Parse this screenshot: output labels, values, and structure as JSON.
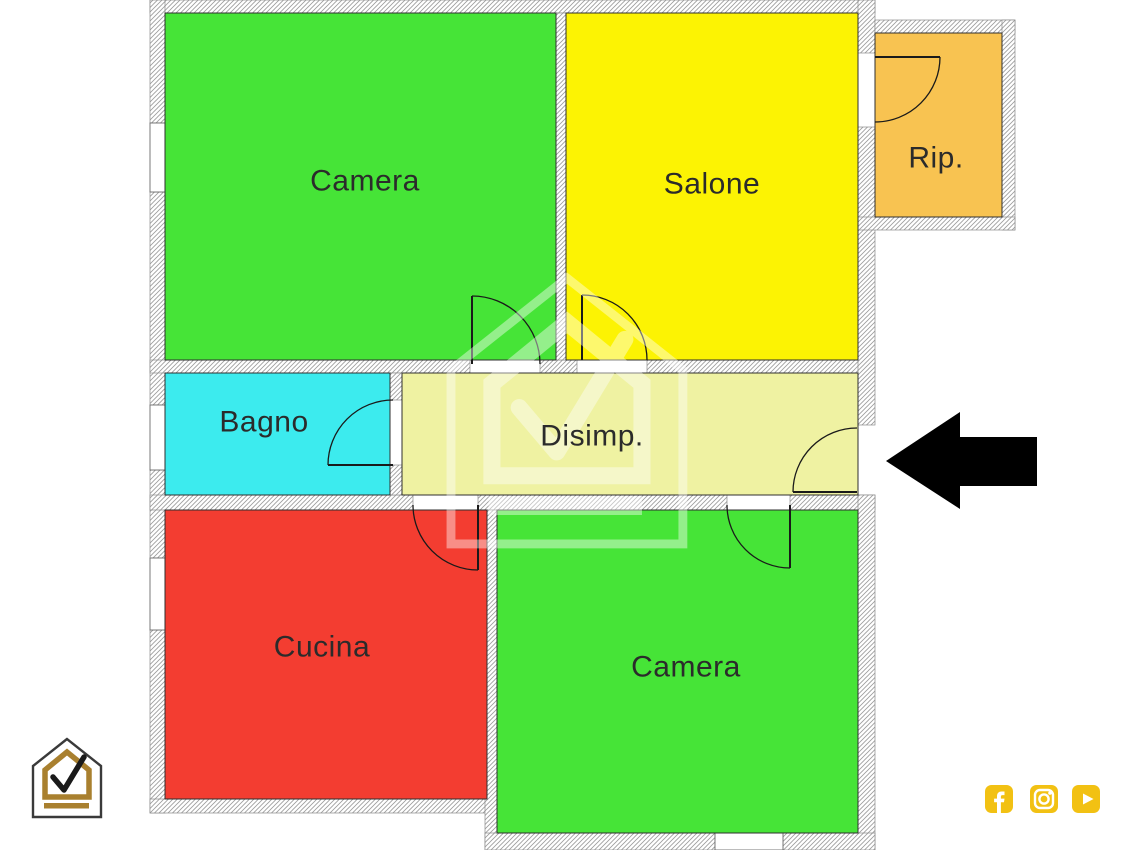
{
  "floorplan": {
    "rooms": {
      "camera1": {
        "label": "Camera",
        "color": "#46e437"
      },
      "salone": {
        "label": "Salone",
        "color": "#fcf303"
      },
      "rip": {
        "label": "Rip.",
        "color": "#f8c351"
      },
      "bagno": {
        "label": "Bagno",
        "color": "#3cebee"
      },
      "disimp": {
        "label": "Disimp.",
        "color": "#eff2a2"
      },
      "cucina": {
        "label": "Cucina",
        "color": "#f33d31"
      },
      "camera2": {
        "label": "Camera",
        "color": "#46e437"
      }
    },
    "wall_hatch_color": "#9b9b9b",
    "label_color": "#2b2b2b"
  },
  "annotations": {
    "entrance_arrow_color": "#000000"
  },
  "branding": {
    "logo": {
      "name": "house-check-logo",
      "outline_color": "#3a3a3a",
      "accent_color": "#a9802f",
      "check_color": "#1a1a1a"
    },
    "watermark": {
      "name": "house-check-watermark",
      "color": "#ffffff"
    },
    "social": {
      "color": "#f2c113",
      "icons": [
        "facebook",
        "instagram",
        "youtube"
      ]
    }
  }
}
